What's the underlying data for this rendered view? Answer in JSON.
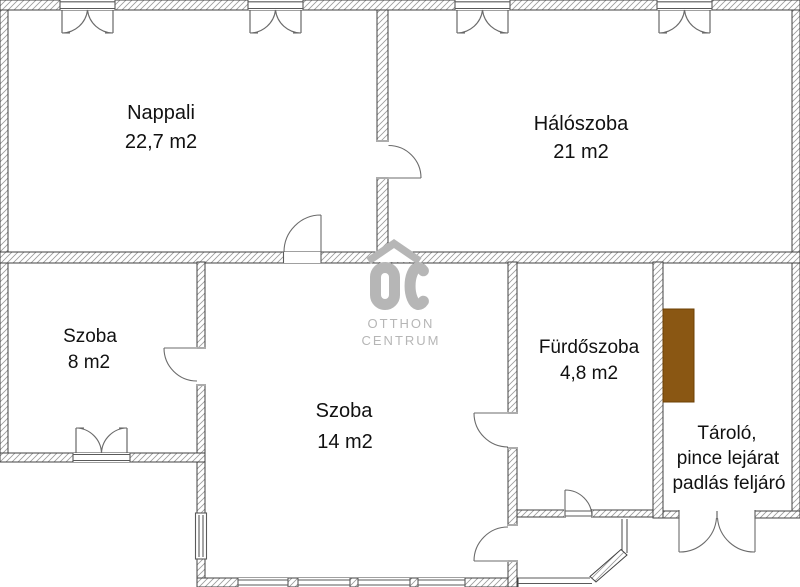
{
  "plan_title": "Lakás alaprajz",
  "rooms": {
    "nappali": {
      "name": "Nappali",
      "area": "22,7 m2"
    },
    "haloszoba": {
      "name": "Hálószoba",
      "area": "21 m2"
    },
    "szoba8": {
      "name": "Szoba",
      "area": "8 m2"
    },
    "szoba14": {
      "name": "Szoba",
      "area": "14 m2"
    },
    "furdoszoba": {
      "name": "Fürdőszoba",
      "area": "4,8 m2"
    },
    "tarolo": {
      "line1": "Tároló,",
      "line2": "pince lejárat",
      "line3": "padlás feljáró"
    }
  },
  "watermark": {
    "logo_letters": "OC",
    "line1": "OTTHON",
    "line2": "CENTRUM"
  },
  "colors": {
    "wall_hatch": "#9b9b9b",
    "wall_outline": "#414141",
    "symbol_line": "#5a5a5a",
    "accent_brown": "#8a5713",
    "watermark_gray": "#b6b6b6",
    "label_text": "#111111"
  }
}
